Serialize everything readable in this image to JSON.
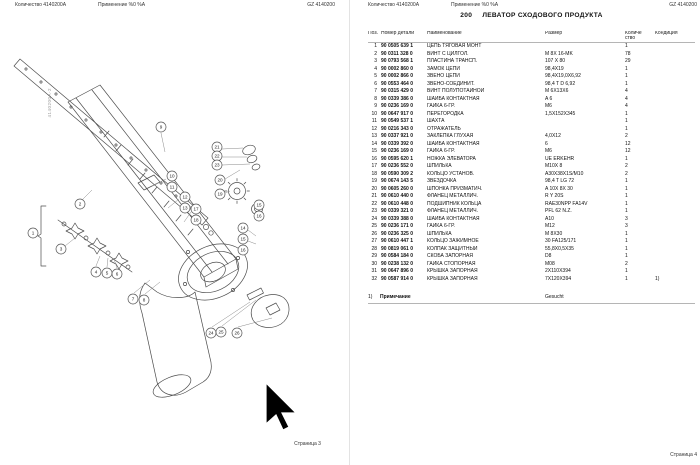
{
  "shared": {
    "header_qty": "Количество 4140200A",
    "header_use": "Применение  %0 %A",
    "header_doc": "GZ 4140200"
  },
  "colors": {
    "line": "#4d4d4d",
    "leader": "#8a8a8a",
    "rule": "#b5b5b5",
    "cursor": "#000000"
  },
  "left_page": {
    "footer": "Страница 3",
    "vertical_label": "4140200A-2",
    "balloons": [
      [
        "1",
        33,
        233
      ],
      [
        "2",
        80,
        204
      ],
      [
        "3",
        61,
        249
      ],
      [
        "4",
        96,
        272
      ],
      [
        "5",
        107,
        273
      ],
      [
        "6",
        117,
        274
      ],
      [
        "7",
        133,
        299
      ],
      [
        "8",
        144,
        300
      ],
      [
        "9",
        161,
        127
      ],
      [
        "10",
        172,
        176
      ],
      [
        "11",
        172,
        187
      ],
      [
        "12",
        185,
        197
      ],
      [
        "13",
        185,
        208
      ],
      [
        "17",
        196,
        209
      ],
      [
        "18",
        196,
        220
      ],
      [
        "19",
        220,
        194
      ],
      [
        "20",
        220,
        180
      ],
      [
        "21",
        217,
        147
      ],
      [
        "22",
        217,
        156
      ],
      [
        "23",
        217,
        165
      ],
      [
        "15",
        259,
        205
      ],
      [
        "16",
        259,
        216
      ],
      [
        "14",
        243,
        228
      ],
      [
        "15",
        243,
        239
      ],
      [
        "16",
        243,
        250
      ],
      [
        "24",
        211,
        333
      ],
      [
        "25",
        221,
        332
      ],
      [
        "26",
        237,
        333
      ]
    ]
  },
  "right_page": {
    "title_no": "200",
    "title": "ЛЕВАТОР СХОДОВОГО ПРОДУКТА",
    "columns": {
      "pos": "Поз.",
      "part": "Номер детали",
      "name": "Наименование",
      "size": "Размер",
      "qty_line1": "Количе",
      "qty_line2": "ство",
      "cond": "Кондиция"
    },
    "rows": [
      [
        "1",
        "90 0505 639 1",
        "ЦЕПЬ ТЯГОВАЯ МОНТ",
        "",
        "1",
        ""
      ],
      [
        "2",
        "90 0311 328 0",
        "ВИНТ С ЦИЛГОЛ.",
        "M 8X 16-MK",
        "78",
        ""
      ],
      [
        "3",
        "90 0793 568 1",
        "ПЛАСТИНА ТРАНСП.",
        "107 X 80",
        "29",
        ""
      ],
      [
        "4",
        "90 0002 860 0",
        "ЗАМОК ЦЕПИ",
        "98,4X19",
        "1",
        ""
      ],
      [
        "5",
        "90 0002 866 0",
        "ЗВЕНО ЦЕПИ",
        "98,4X19,0X6,92",
        "1",
        ""
      ],
      [
        "6",
        "90 0553 464 0",
        "ЗВЕНО-СОЕДИНИТ.",
        "98,4 T D 6,92",
        "1",
        ""
      ],
      [
        "7",
        "90 0315 429 0",
        "ВИНТ ПОЛУПОТАЙНОЙ",
        "M 6X13X6",
        "4",
        ""
      ],
      [
        "8",
        "90 0339 386 0",
        "ШАЙБА КОНТАКТНАЯ",
        "A 6",
        "4",
        ""
      ],
      [
        "9",
        "90 0236 169 0",
        "ГАЙКА 6-ГР.",
        "M6",
        "4",
        ""
      ],
      [
        "10",
        "90 0647 917 0",
        "ПЕРЕГОРОДКА",
        "1,5X152X345",
        "1",
        ""
      ],
      [
        "11",
        "90 0549 537 1",
        "ШАХТА",
        "",
        "1",
        ""
      ],
      [
        "12",
        "90 0216 343 0",
        "ОТРАЖАТЕЛЬ",
        "",
        "1",
        ""
      ],
      [
        "13",
        "90 0337 921 0",
        "ЗАКЛЕПКА ГЛУХАЯ",
        "4,0X12",
        "2",
        ""
      ],
      [
        "14",
        "90 0339 392 0",
        "ШАЙБА КОНТАКТНАЯ",
        "6",
        "12",
        ""
      ],
      [
        "15",
        "90 0236 169 0",
        "ГАЙКА 6-ГР.",
        "M6",
        "12",
        ""
      ],
      [
        "16",
        "90 0595 620 1",
        "НОЖКА ЭЛЕВАТОРА",
        "UE ERKEHR",
        "1",
        ""
      ],
      [
        "17",
        "90 0236 552 0",
        "ШПИЛЬКА",
        "M10X 8",
        "2",
        ""
      ],
      [
        "18",
        "90 0590 309 2",
        "КОЛЬЦО УСТАНОВ.",
        "A30X38X1S/M10",
        "2",
        ""
      ],
      [
        "19",
        "90 0674 143 5",
        "ЗВЕЗДОЧКА",
        "98,4 T LG 72",
        "1",
        ""
      ],
      [
        "20",
        "90 0605 260 0",
        "ШПОНКА ПРИЗМАТИЧ.",
        "A 10X 8X 30",
        "1",
        ""
      ],
      [
        "21",
        "90 0610 440 0",
        "ФЛАНЕЦ МЕТАЛЛИЧ.",
        "R Y 20S",
        "1",
        ""
      ],
      [
        "22",
        "90 0610 448 0",
        "ПОДШИПНИК КОЛЬЦА",
        "RAE30NPP FA14V",
        "1",
        ""
      ],
      [
        "23",
        "90 0339 321 0",
        "ФЛАНЕЦ МЕТАЛЛИЧ.",
        "PFL 62 N.Z.",
        "1",
        ""
      ],
      [
        "24",
        "90 0339 388 0",
        "ШАЙБА КОНТАКТНАЯ",
        "A10",
        "3",
        ""
      ],
      [
        "25",
        "90 0236 171 0",
        "ГАЙКА 6-ГР.",
        "M12",
        "3",
        ""
      ],
      [
        "26",
        "90 0236 325 0",
        "ШПИЛЬКА",
        "M 8X30",
        "1",
        ""
      ],
      [
        "27",
        "90 0610 447 1",
        "КОЛЬЦО ЗАЖИМНОЕ",
        "30  FA125/171",
        "1",
        ""
      ],
      [
        "28",
        "90 0819 061 0",
        "КОЛПАК ЗАЩИТНЫЙ",
        "55,8X0,5X35",
        "1",
        ""
      ],
      [
        "29",
        "90 0584 184 0",
        "СКОБА ЗАПОРНАЯ",
        "D8",
        "1",
        ""
      ],
      [
        "30",
        "90 0238 132 0",
        "ГАЙКА СТОПОРНАЯ",
        "M08",
        "2",
        ""
      ],
      [
        "31",
        "90 0647 896 0",
        "КРЫШКА ЗАПОРНАЯ",
        "2X110X394",
        "1",
        ""
      ],
      [
        "32",
        "90 0587 914 0",
        "КРЫШКА ЗАПОРНАЯ",
        "7X120X394",
        "1",
        "1)"
      ]
    ],
    "footnote": {
      "marker": "1)",
      "label": "Примечание",
      "value": "Gesucht"
    },
    "footer": "Страница 4"
  }
}
